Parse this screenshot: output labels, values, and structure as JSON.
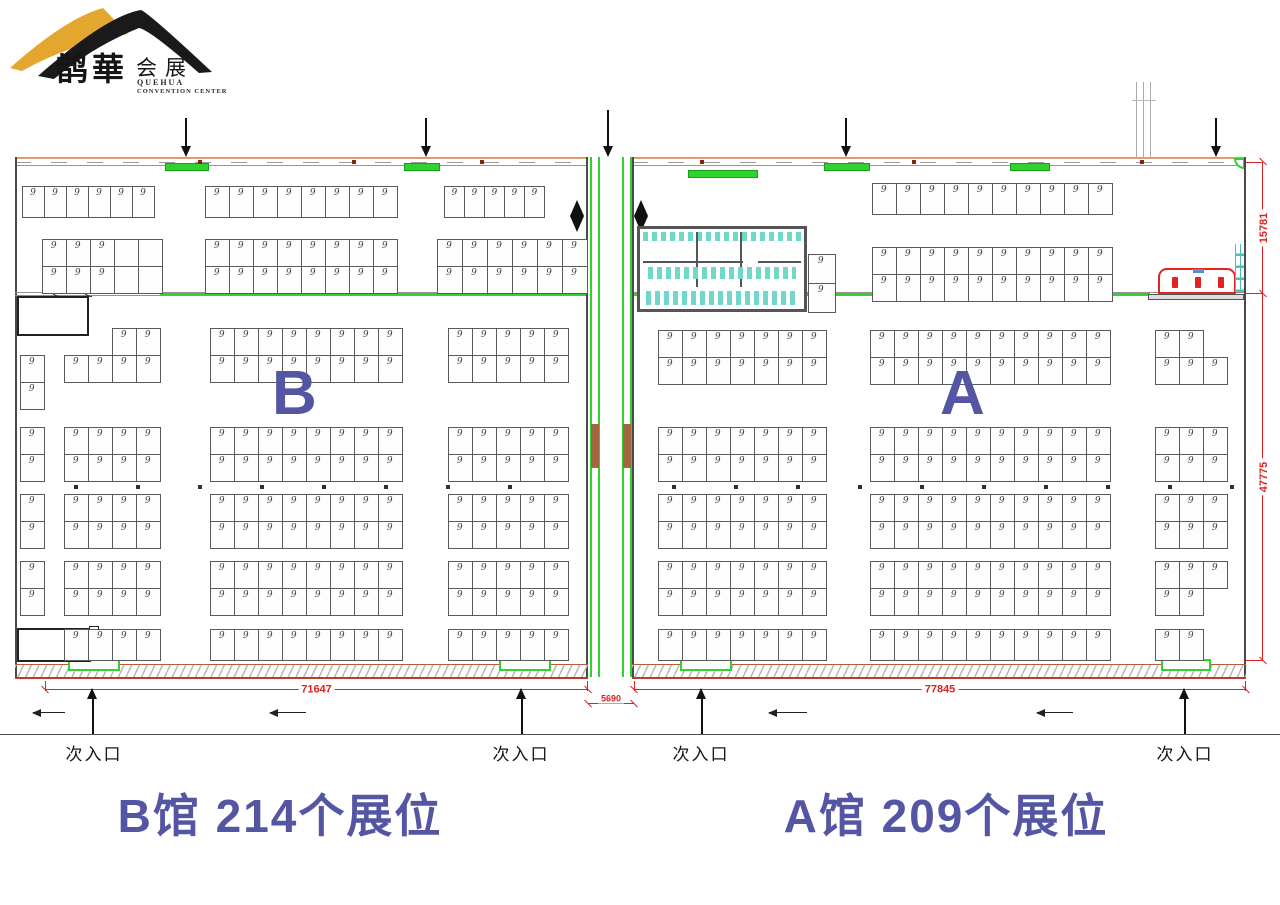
{
  "logo": {
    "brand_zh": "鹊華",
    "brand_suffix": "会展",
    "en_line1": "QUEHUA",
    "en_line2": "CONVENTION CENTER",
    "gold": "#e3a72f",
    "black": "#1a1a1a"
  },
  "halls": {
    "b": {
      "letter": "B",
      "title": "B馆  214个展位",
      "booth_count": "214"
    },
    "a": {
      "letter": "A",
      "title": "A馆  209个展位",
      "booth_count": "209"
    }
  },
  "dimensions": {
    "b_width": "71647",
    "corridor_width": "5690",
    "a_width": "77845",
    "right_upper": "15781",
    "right_lower": "47775",
    "color": "#dd2222"
  },
  "entrances": {
    "label": "次入口"
  },
  "colors": {
    "accent_blue": "#5456a3",
    "door_green": "#2fd32f",
    "wall_orange": "#e09c6c",
    "restroom_teal": "#6fd8cb",
    "dim_red": "#dd2222",
    "booth_border": "#5a5a5a"
  },
  "floor": {
    "booth_label": "9",
    "blocks": [
      {
        "hall": "b",
        "x": 22,
        "y": 186,
        "cols": 6,
        "rows": 1,
        "cw": 22,
        "ch": 31
      },
      {
        "hall": "b",
        "x": 205,
        "y": 186,
        "cols": 8,
        "rows": 1,
        "ch": 31
      },
      {
        "hall": "b",
        "x": 444,
        "y": 186,
        "cols": 5,
        "rows": 1,
        "cw": 20,
        "ch": 31
      },
      {
        "hall": "b",
        "x": 42,
        "y": 239,
        "cols": 5,
        "rows": 2,
        "empty": [
          3,
          4,
          8,
          9
        ]
      },
      {
        "hall": "b",
        "x": 205,
        "y": 239,
        "cols": 8,
        "rows": 2
      },
      {
        "hall": "b",
        "x": 437,
        "y": 239,
        "cols": 6,
        "rows": 2,
        "cw": 25
      },
      {
        "hall": "b",
        "x": 112,
        "y": 328,
        "cols": 2,
        "rows": 1
      },
      {
        "hall": "b",
        "x": 64,
        "y": 355,
        "cols": 4,
        "rows": 1
      },
      {
        "hall": "b",
        "x": 210,
        "y": 328,
        "cols": 8,
        "rows": 2
      },
      {
        "hall": "b",
        "x": 448,
        "y": 328,
        "cols": 5,
        "rows": 2
      },
      {
        "hall": "b",
        "x": 20,
        "y": 355,
        "cols": 1,
        "rows": 2
      },
      {
        "hall": "b",
        "x": 20,
        "y": 427,
        "cols": 1,
        "rows": 2
      },
      {
        "hall": "b",
        "x": 64,
        "y": 427,
        "cols": 4,
        "rows": 2
      },
      {
        "hall": "b",
        "x": 210,
        "y": 427,
        "cols": 8,
        "rows": 2
      },
      {
        "hall": "b",
        "x": 448,
        "y": 427,
        "cols": 5,
        "rows": 2
      },
      {
        "hall": "b",
        "x": 20,
        "y": 494,
        "cols": 1,
        "rows": 2
      },
      {
        "hall": "b",
        "x": 64,
        "y": 494,
        "cols": 4,
        "rows": 2
      },
      {
        "hall": "b",
        "x": 210,
        "y": 494,
        "cols": 8,
        "rows": 2
      },
      {
        "hall": "b",
        "x": 448,
        "y": 494,
        "cols": 5,
        "rows": 2
      },
      {
        "hall": "b",
        "x": 20,
        "y": 561,
        "cols": 1,
        "rows": 2
      },
      {
        "hall": "b",
        "x": 64,
        "y": 561,
        "cols": 4,
        "rows": 2
      },
      {
        "hall": "b",
        "x": 210,
        "y": 561,
        "cols": 8,
        "rows": 2
      },
      {
        "hall": "b",
        "x": 448,
        "y": 561,
        "cols": 5,
        "rows": 2
      },
      {
        "hall": "b",
        "x": 64,
        "y": 629,
        "cols": 4,
        "rows": 1,
        "ch": 31
      },
      {
        "hall": "b",
        "x": 210,
        "y": 629,
        "cols": 8,
        "rows": 1,
        "ch": 31
      },
      {
        "hall": "b",
        "x": 448,
        "y": 629,
        "cols": 5,
        "rows": 1,
        "ch": 31
      },
      {
        "hall": "a",
        "x": 872,
        "y": 183,
        "cols": 10,
        "rows": 1,
        "ch": 31
      },
      {
        "hall": "a",
        "x": 808,
        "y": 254,
        "cols": 1,
        "rows": 2,
        "cw": 27,
        "ch": 29
      },
      {
        "hall": "a",
        "x": 872,
        "y": 247,
        "cols": 10,
        "rows": 2
      },
      {
        "hall": "a",
        "x": 658,
        "y": 330,
        "cols": 7,
        "rows": 2
      },
      {
        "hall": "a",
        "x": 870,
        "y": 330,
        "cols": 10,
        "rows": 2
      },
      {
        "hall": "a",
        "x": 1155,
        "y": 330,
        "cols": 2,
        "rows": 1
      },
      {
        "hall": "a",
        "x": 1155,
        "y": 357,
        "cols": 3,
        "rows": 1
      },
      {
        "hall": "a",
        "x": 658,
        "y": 427,
        "cols": 7,
        "rows": 2
      },
      {
        "hall": "a",
        "x": 870,
        "y": 427,
        "cols": 10,
        "rows": 2
      },
      {
        "hall": "a",
        "x": 1155,
        "y": 427,
        "cols": 3,
        "rows": 2
      },
      {
        "hall": "a",
        "x": 658,
        "y": 494,
        "cols": 7,
        "rows": 2
      },
      {
        "hall": "a",
        "x": 870,
        "y": 494,
        "cols": 10,
        "rows": 2
      },
      {
        "hall": "a",
        "x": 1155,
        "y": 494,
        "cols": 3,
        "rows": 2
      },
      {
        "hall": "a",
        "x": 658,
        "y": 561,
        "cols": 7,
        "rows": 2
      },
      {
        "hall": "a",
        "x": 870,
        "y": 561,
        "cols": 10,
        "rows": 2
      },
      {
        "hall": "a",
        "x": 1155,
        "y": 561,
        "cols": 3,
        "rows": 1
      },
      {
        "hall": "a",
        "x": 1155,
        "y": 588,
        "cols": 2,
        "rows": 1
      },
      {
        "hall": "a",
        "x": 658,
        "y": 629,
        "cols": 7,
        "rows": 1,
        "ch": 31
      },
      {
        "hall": "a",
        "x": 870,
        "y": 629,
        "cols": 10,
        "rows": 1,
        "ch": 31
      },
      {
        "hall": "a",
        "x": 1155,
        "y": 629,
        "cols": 2,
        "rows": 1,
        "ch": 31
      }
    ],
    "dot_rows": [
      {
        "y": 485,
        "x1": 74,
        "x2": 556,
        "step": 62
      },
      {
        "y": 485,
        "x1": 672,
        "x2": 1240,
        "step": 62
      }
    ]
  }
}
